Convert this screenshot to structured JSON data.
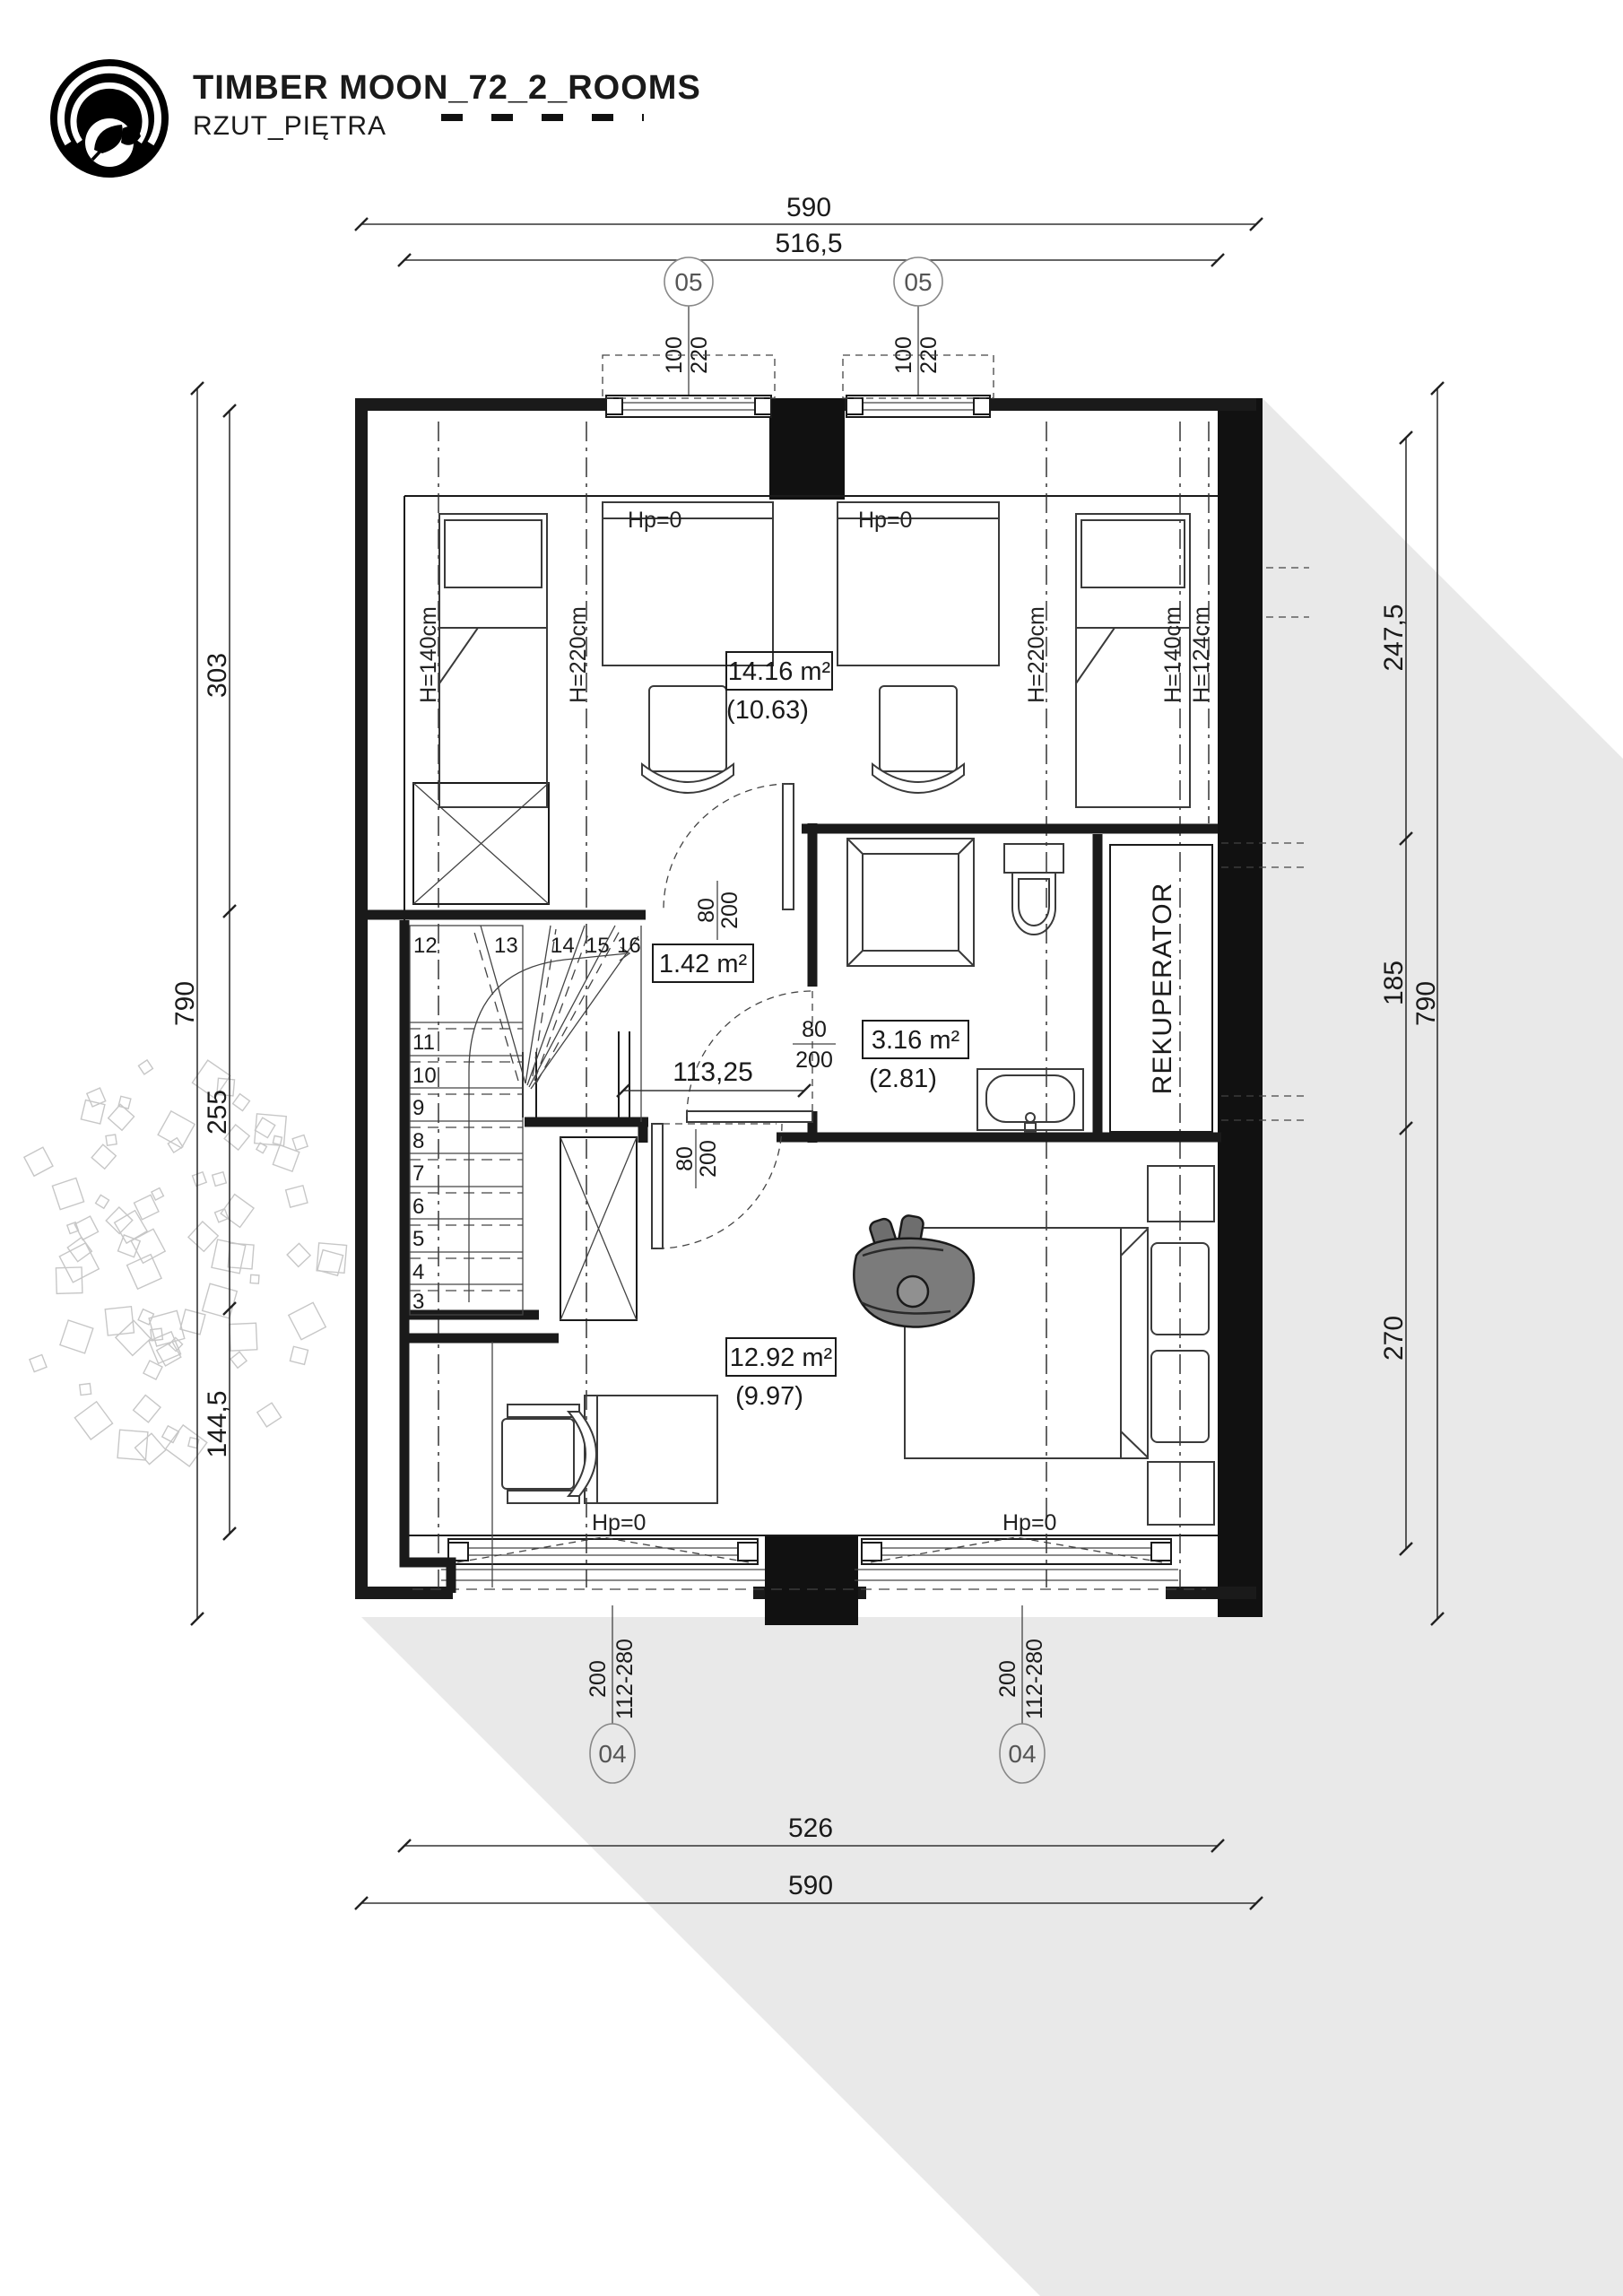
{
  "header": {
    "title": "TIMBER MOON_72_2_ROOMS",
    "subtitle": "RZUT_PIĘTRA"
  },
  "dimensions": {
    "top_outer": "590",
    "top_inner": "516,5",
    "bottom_inner": "526",
    "bottom_outer": "590",
    "left": {
      "segments": [
        "303",
        "255",
        "144,5"
      ],
      "total": "790"
    },
    "right": {
      "segments": [
        "247,5",
        "185",
        "270"
      ],
      "total": "790"
    }
  },
  "markers": {
    "top": [
      {
        "id": "05",
        "size": "100",
        "height": "220"
      },
      {
        "id": "05",
        "size": "100",
        "height": "220"
      }
    ],
    "bottom": [
      {
        "id": "04",
        "size": "200",
        "height": "112-280"
      },
      {
        "id": "04",
        "size": "200",
        "height": "112-280"
      }
    ]
  },
  "rooms": [
    {
      "name": "bedroom-top",
      "area": "14.16 m²",
      "reduced": "(10.63)"
    },
    {
      "name": "hall",
      "area": "1.42 m²",
      "reduced": ""
    },
    {
      "name": "bathroom",
      "area": "3.16 m²",
      "reduced": "(2.81)"
    },
    {
      "name": "bedroom-bottom",
      "area": "12.92 m²",
      "reduced": "(9.97)"
    }
  ],
  "labels": {
    "rekuperator": "REKUPERATOR",
    "hp0": "Hp=0",
    "heights": [
      "H=140cm",
      "H=220cm",
      "H=220cm",
      "H=140cm",
      "H=124cm"
    ],
    "door": {
      "w": "80",
      "h": "200"
    },
    "hall_width": "113,25"
  },
  "stairs": {
    "numbers": [
      "3",
      "4",
      "5",
      "6",
      "7",
      "8",
      "9",
      "10",
      "11",
      "12",
      "13",
      "14",
      "15",
      "16"
    ]
  },
  "colors": {
    "shadow": "#e9e9e9",
    "line": "#1a1a1a",
    "person": "#7b7b7b"
  }
}
